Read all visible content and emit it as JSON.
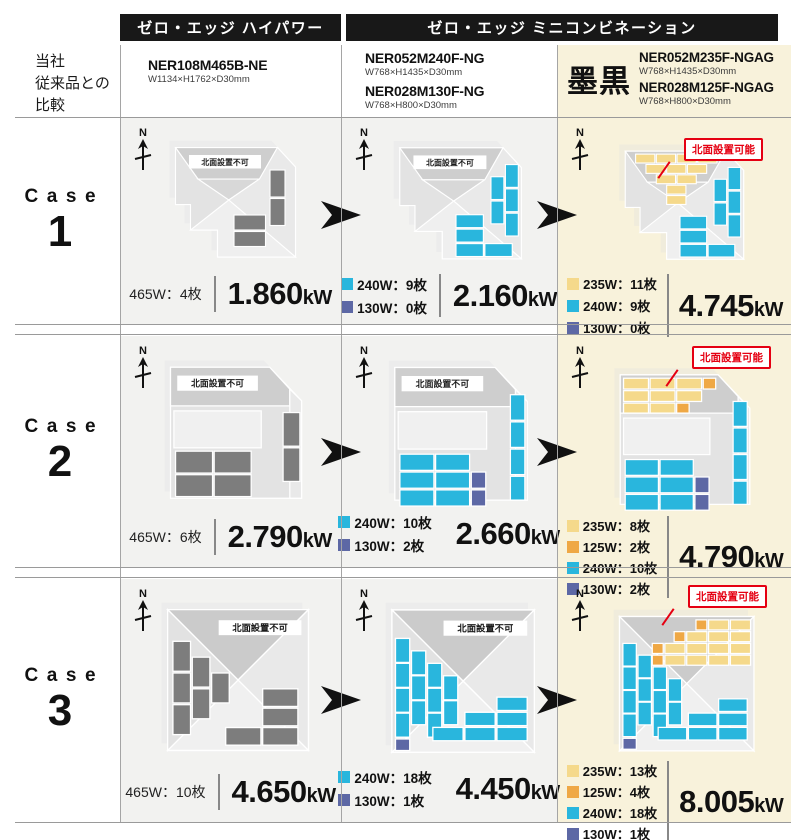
{
  "header": {
    "bar1": "ゼロ・エッジ  ハイパワー",
    "bar2": "ゼロ・エッジ  ミニコンビネーション",
    "left_label_line1": "当社",
    "left_label_line2": "従来品との",
    "left_label_line3": "比較"
  },
  "products": {
    "col1": {
      "model1_name": "NER108M465B-NE",
      "model1_size": "W1134×H1762×D30mm"
    },
    "col2": {
      "model1_name": "NER052M240F-NG",
      "model1_size": "W768×H1435×D30mm",
      "model2_name": "NER028M130F-NG",
      "model2_size": "W768×H800×D30mm"
    },
    "col3": {
      "finish_label": "墨黒",
      "model1_name": "NER052M235F-NGAG",
      "model1_size": "W768×H1435×D30mm",
      "model2_name": "NER028M125F-NGAG",
      "model2_size": "W768×H800×D30mm"
    }
  },
  "labels": {
    "north": "N",
    "north_not_allowed": "北面設置不可",
    "north_allowed": "北面設置可能",
    "case_word": "Case",
    "kw_unit": "kW"
  },
  "colors": {
    "cyan_240w": "#29b6dd",
    "purple_130w": "#5d68a5",
    "yellow_235w": "#f5d98b",
    "orange_125w": "#efa845",
    "gray_465w": "#7d7d7d",
    "accent_red": "#e50012",
    "cream_bg": "#f8f2db",
    "cell_bg": "#f2f2f0",
    "bar_bg": "#181818"
  },
  "cases": [
    {
      "number": "1",
      "col1": {
        "panels": "465W：4枚",
        "kw": "1.860"
      },
      "col2": {
        "legend": [
          {
            "color": "cyan",
            "label": "240W：9枚"
          },
          {
            "color": "purple",
            "label": "130W：0枚"
          }
        ],
        "kw": "2.160"
      },
      "col3": {
        "legend": [
          {
            "color": "yellow",
            "label": "235W：11枚"
          },
          {
            "color": "cyan",
            "label": "240W：9枚"
          },
          {
            "color": "purple",
            "label": "130W：0枚"
          }
        ],
        "kw": "4.745"
      }
    },
    {
      "number": "2",
      "col1": {
        "panels": "465W：6枚",
        "kw": "2.790"
      },
      "col2": {
        "legend": [
          {
            "color": "cyan",
            "label": "240W：10枚"
          },
          {
            "color": "purple",
            "label": "130W：2枚"
          }
        ],
        "kw": "2.660"
      },
      "col3": {
        "legend": [
          {
            "color": "yellow",
            "label": "235W：8枚"
          },
          {
            "color": "orange",
            "label": "125W：2枚"
          },
          {
            "color": "cyan",
            "label": "240W：10枚"
          },
          {
            "color": "purple",
            "label": "130W：2枚"
          }
        ],
        "kw": "4.790"
      }
    },
    {
      "number": "3",
      "col1": {
        "panels": "465W：10枚",
        "kw": "4.650"
      },
      "col2": {
        "legend": [
          {
            "color": "cyan",
            "label": "240W：18枚"
          },
          {
            "color": "purple",
            "label": "130W：1枚"
          }
        ],
        "kw": "4.450"
      },
      "col3": {
        "legend": [
          {
            "color": "yellow",
            "label": "235W：13枚"
          },
          {
            "color": "orange",
            "label": "125W：4枚"
          },
          {
            "color": "cyan",
            "label": "240W：18枚"
          },
          {
            "color": "purple",
            "label": "130W：1枚"
          }
        ],
        "kw": "8.005"
      }
    }
  ]
}
